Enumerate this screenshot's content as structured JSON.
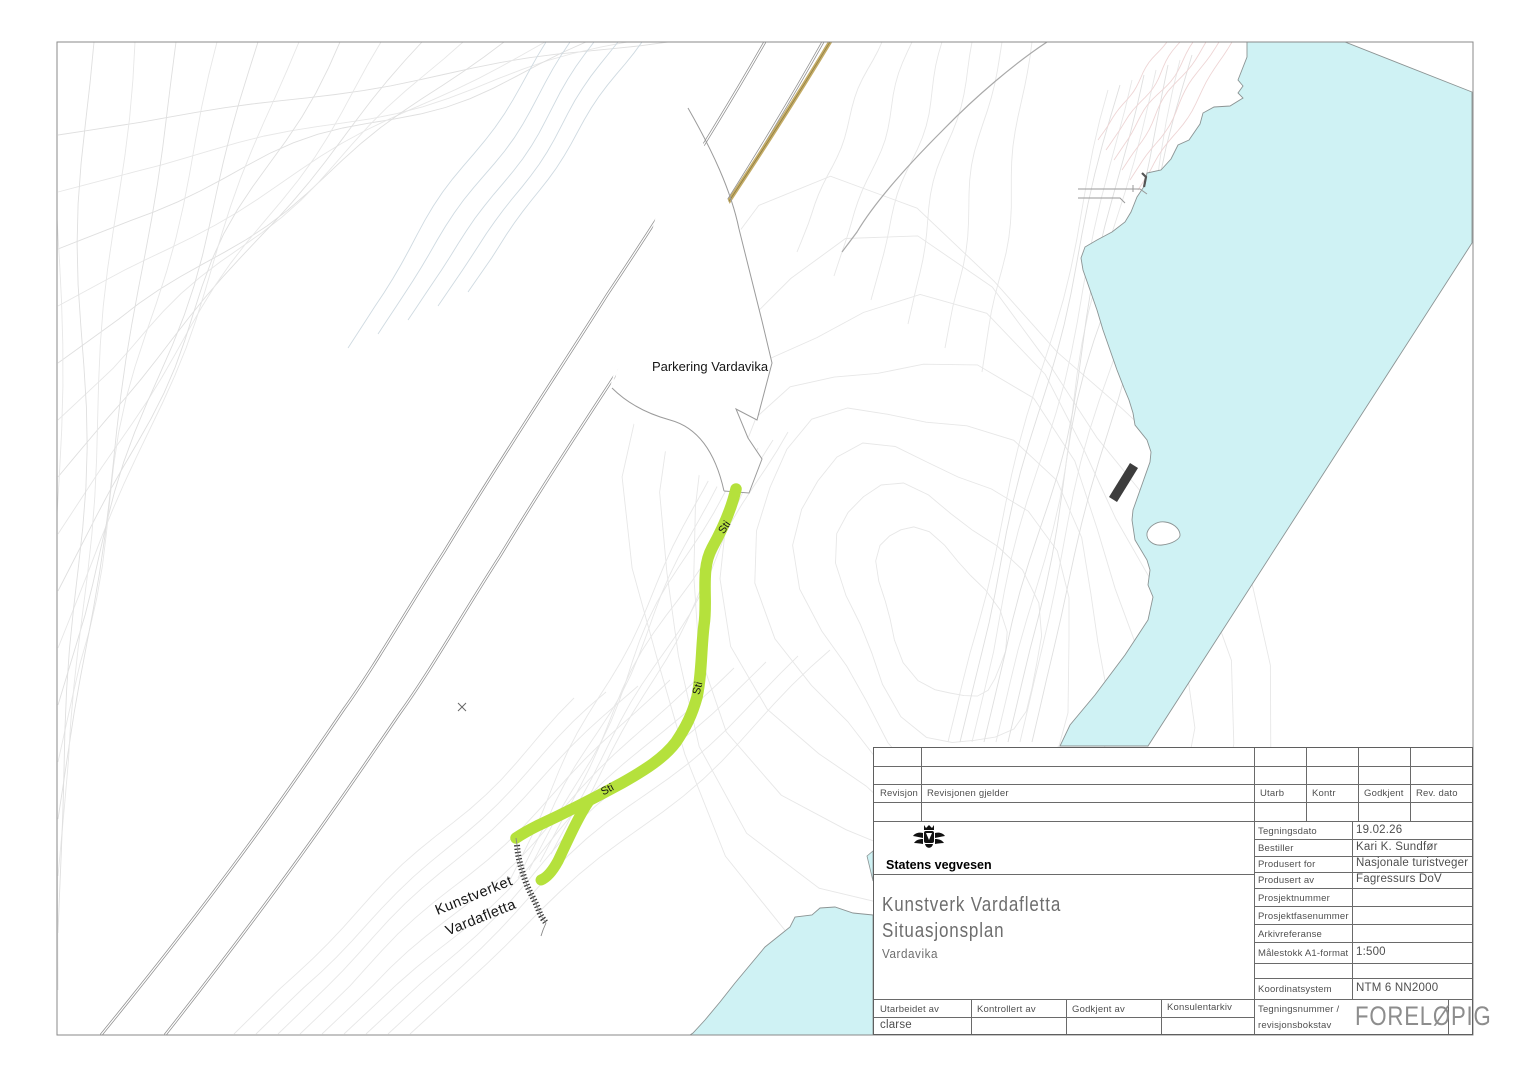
{
  "map": {
    "parkering_label": "Parkering Vardavika",
    "sti_label": "Sti",
    "kunstverket_line1": "Kunstverket",
    "kunstverket_line2": "Vardafletta"
  },
  "colors": {
    "water": "#cff2f4",
    "trail": "#b5e13c",
    "guardrail": "#c3ab66",
    "building": "#3d3d3d"
  },
  "title_block": {
    "org": "Statens vegvesen",
    "project_title": "Kunstverk Vardafletta",
    "drawing_type": "Situasjonsplan",
    "location": "Vardavika",
    "stamp": "FORELØPIG",
    "revision": {
      "col_revisjon": "Revisjon",
      "col_gjelder": "Revisjonen gjelder",
      "col_utarb": "Utarb",
      "col_kontr": "Kontr",
      "col_godkjent": "Godkjent",
      "col_revdato": "Rev. dato"
    },
    "fields": [
      {
        "label": "Tegningsdato",
        "value": "19.02.26"
      },
      {
        "label": "Bestiller",
        "value": "Kari K. Sundfør"
      },
      {
        "label": "Produsert for",
        "value": "Nasjonale turistveger"
      },
      {
        "label": "Produsert av",
        "value": "Fagressurs DoV"
      },
      {
        "label": "Prosjektnummer",
        "value": ""
      },
      {
        "label": "Prosjektfasenummer",
        "value": ""
      },
      {
        "label": "Arkivreferanse",
        "value": ""
      },
      {
        "label": "Målestokk A1-format",
        "value": "1:500"
      },
      {
        "label": "Koordinatsystem",
        "value": "NTM 6 NN2000"
      }
    ],
    "tegningsnummer_label1": "Tegningsnummer /",
    "tegningsnummer_label2": "revisjonsbokstav",
    "signatures": {
      "utarbeidet_label": "Utarbeidet av",
      "utarbeidet_value": "clarse",
      "kontrollert_label": "Kontrollert av",
      "godkjent_label": "Godkjent av",
      "konsulentarkiv_label": "Konsulentarkiv"
    }
  }
}
